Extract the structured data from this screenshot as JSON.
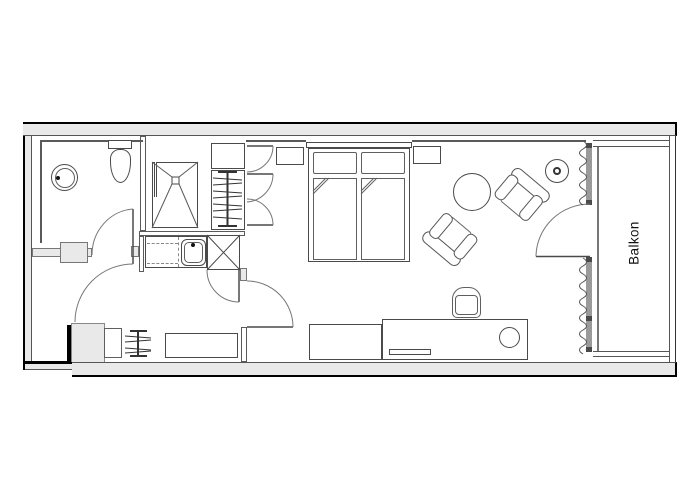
{
  "balcony": {
    "label": "Balkon"
  },
  "colors": {
    "background": "#ffffff",
    "wall_fill": "#e9e9e9",
    "exterior_outline": "#000000",
    "interior_line": "#5a5a5a",
    "furniture_line": "#4a4a4a",
    "glazing_fill": "#9a9a9a"
  }
}
